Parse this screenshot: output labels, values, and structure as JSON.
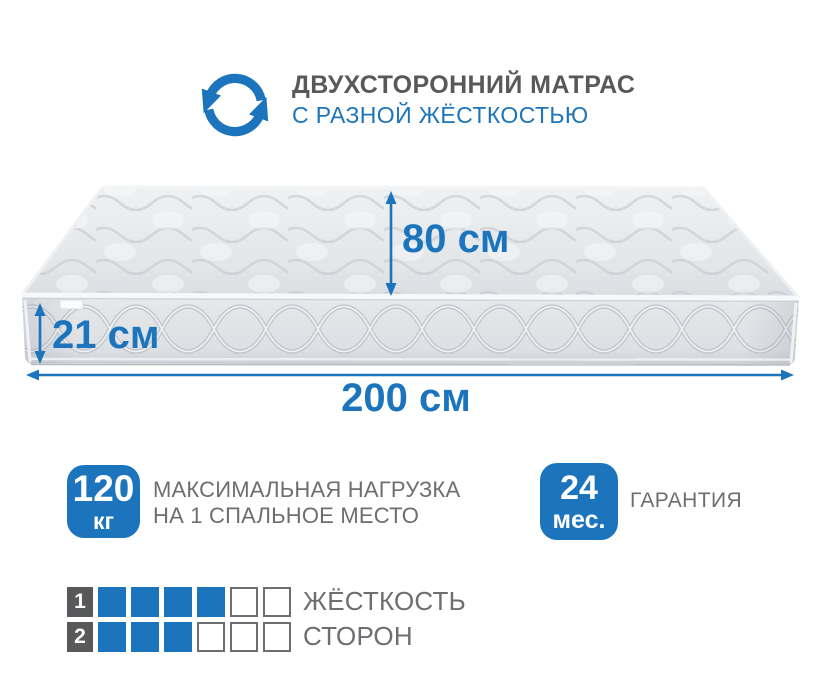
{
  "colors": {
    "accent_blue": "#1c75bc",
    "title_gray": "#58595b",
    "text_gray": "#6d6e71",
    "mattress_light": "#e9ebee",
    "mattress_shade": "#d3d6da"
  },
  "header": {
    "icon": "flip-arrows-icon",
    "title": "ДВУХСТОРОННИЙ МАТРАС",
    "subtitle": "С РАЗНОЙ ЖЁСТКОСТЬЮ"
  },
  "mattress": {
    "height_label": "80 см",
    "thickness_label": "21 см",
    "width_label": "200 см"
  },
  "badges": {
    "max_load": {
      "value": "120",
      "unit": "кг",
      "line1": "МАКСИМАЛЬНАЯ НАГРУЗКА",
      "line2": "НА 1 СПАЛЬНОЕ МЕСТО"
    },
    "warranty": {
      "value": "24",
      "unit": "мес.",
      "label": "ГАРАНТИЯ"
    }
  },
  "firmness": {
    "label_line1": "ЖЁСТКОСТЬ",
    "label_line2": "СТОРОН",
    "rows": [
      {
        "side": "1",
        "filled": 4,
        "total": 6
      },
      {
        "side": "2",
        "filled": 3,
        "total": 6
      }
    ]
  }
}
